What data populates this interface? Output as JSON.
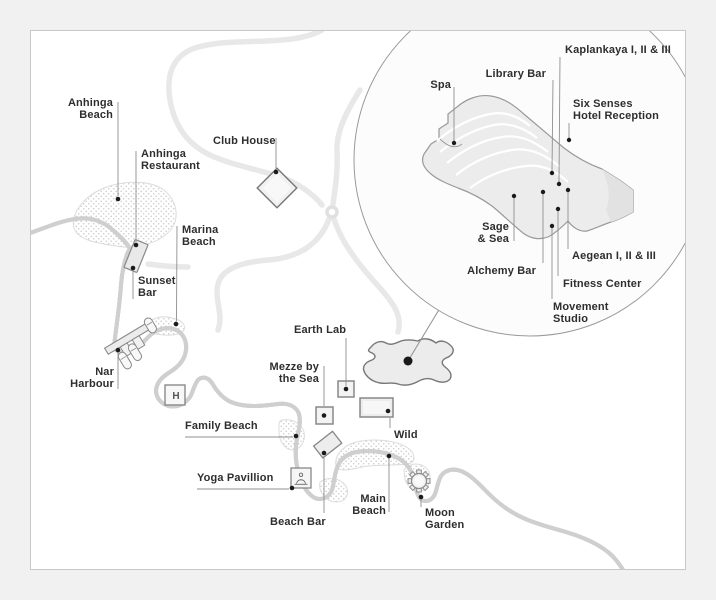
{
  "map_labels": {
    "anhinga_beach": "Anhinga\nBeach",
    "anhinga_restaurant": "Anhinga\nRestaurant",
    "club_house": "Club House",
    "marina_beach": "Marina\nBeach",
    "sunset_bar": "Sunset\nBar",
    "nar_harbour": "Nar\nHarbour",
    "family_beach": "Family Beach",
    "yoga_pavillion": "Yoga Pavillion",
    "beach_bar": "Beach Bar",
    "main_beach": "Main\nBeach",
    "moon_garden": "Moon\nGarden",
    "wild": "Wild",
    "earth_lab": "Earth Lab",
    "mezze_by_the_sea": "Mezze by\nthe Sea"
  },
  "inset_labels": {
    "spa": "Spa",
    "library_bar": "Library Bar",
    "kaplankaya": "Kaplankaya I, II & III",
    "six_senses_hotel_reception": "Six Senses\nHotel Reception",
    "sage_and_sea": "Sage\n& Sea",
    "alchemy_bar": "Alchemy Bar",
    "aegean": "Aegean I, II & III",
    "fitness_center": "Fitness Center",
    "movement_studio": "Movement\nStudio"
  },
  "helipad_letter": "H",
  "colors": {
    "background": "#f1f1f2",
    "panel": "#ffffff",
    "panel_border": "#c8c8c8",
    "coastline": "#9b9b9b",
    "wave_line": "#e2e2e2",
    "beach_dots": "#c9c9c9",
    "road": "#e8e8e8",
    "building_fill": "#ececec",
    "building_stroke": "#8a8a8a",
    "marker_dot": "#1a1a1a",
    "leader_line": "#8f8f8f",
    "label_text": "#2e2e2e"
  }
}
